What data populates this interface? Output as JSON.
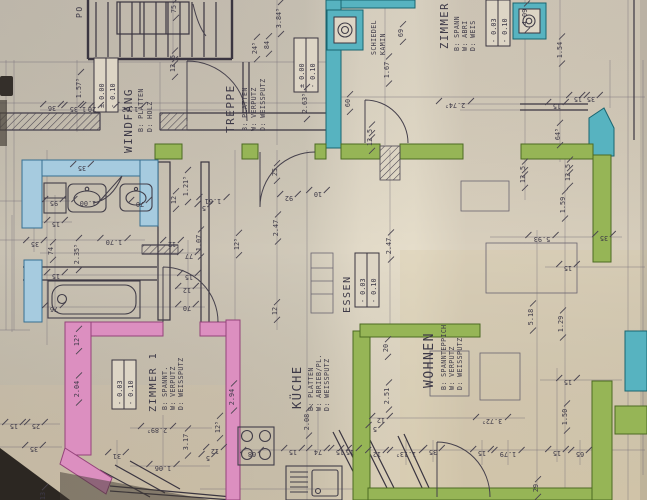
{
  "document": {
    "type": "hand-drawn architectural floor plan (photo, rotated)",
    "language": "German"
  },
  "colors": {
    "paper": "#d5ccba",
    "ink": "#3d3947",
    "wall_blue": "#a6cbdf",
    "wall_teal": "#57b3c0",
    "wall_green": "#96b556",
    "wall_pink": "#dc8fc0"
  },
  "rooms": [
    {
      "id": "windfang",
      "name": "WINDFANG",
      "spec": [
        "B: PLATTEN",
        "D: HOLZ"
      ],
      "level": [
        "± 0.00",
        "- 0.10"
      ]
    },
    {
      "id": "treppe",
      "name": "TREPPE",
      "spec": [
        "B: PLATTEN",
        "W: VERPUTZ",
        "D: WEISSPUTZ"
      ],
      "level": [
        "± 0.00",
        "- 0.10"
      ]
    },
    {
      "id": "zimmer",
      "name": "ZIMMER",
      "spec": [
        "B: SPANN",
        "W: ABRI",
        "D: WEIS"
      ],
      "level": [
        "- 0.03",
        "- 0.10"
      ]
    },
    {
      "id": "essen",
      "name": "ESSEN",
      "spec": [],
      "level": [
        "- 0.03",
        "- 0.10"
      ]
    },
    {
      "id": "wohnen",
      "name": "WOHNEN",
      "spec": [
        "B: SPANNTEPPICH",
        "W: VERPUTZ",
        "D: WEISSPUTZ"
      ],
      "level": null
    },
    {
      "id": "zimmer1",
      "name": "ZIMMER 1",
      "spec": [
        "B: SPANNT.",
        "W: VERPUTZ",
        "D: WEISSPUTZ"
      ],
      "level": [
        "- 0.03",
        "- 0.10"
      ]
    },
    {
      "id": "kueche",
      "name": "KÜCHE",
      "spec": [
        "B: PLATTEN",
        "W: ABRIEB/PL.",
        "D: WEISSPUTZ"
      ],
      "level": null
    },
    {
      "id": "kamin",
      "name": "SCHIEDEL",
      "name2": "KAMIN"
    },
    {
      "id": "stair",
      "name": "PO"
    }
  ],
  "fixtures": [
    "chimney",
    "second-flue",
    "washbasin-large",
    "washbasin-small",
    "cabinet",
    "bathtub",
    "stove-4-burner",
    "kitchen-sink-with-drainboard",
    "dining-table",
    "stair-treads"
  ],
  "dimensions": [
    {
      "t": "75",
      "x": 176,
      "y": 9,
      "r": -90
    },
    {
      "t": "3.84⁵",
      "x": 281,
      "y": 18,
      "r": -90
    },
    {
      "t": "84",
      "x": 269,
      "y": 45,
      "r": -90
    },
    {
      "t": "24⁵",
      "x": 257,
      "y": 48,
      "r": -90
    },
    {
      "t": "1.57⁵",
      "x": 81,
      "y": 88,
      "r": -90
    },
    {
      "t": "69",
      "x": 403,
      "y": 33,
      "r": -90
    },
    {
      "t": "4.09",
      "x": 527,
      "y": 17,
      "r": -90
    },
    {
      "t": "1.54",
      "x": 562,
      "y": 50,
      "r": -90
    },
    {
      "t": "1.67",
      "x": 389,
      "y": 70,
      "r": -90
    },
    {
      "t": "2.63⁵",
      "x": 307,
      "y": 103,
      "r": -90
    },
    {
      "t": "60",
      "x": 350,
      "y": 103,
      "r": -90
    },
    {
      "t": "64⁵",
      "x": 560,
      "y": 134,
      "r": -90
    },
    {
      "t": "5",
      "x": 175,
      "y": 57,
      "r": -90
    },
    {
      "t": "12",
      "x": 175,
      "y": 68,
      "r": -90
    },
    {
      "t": "5",
      "x": 372,
      "y": 131,
      "r": -90
    },
    {
      "t": "12",
      "x": 372,
      "y": 142,
      "r": -90
    },
    {
      "t": "5",
      "x": 525,
      "y": 168,
      "r": -90
    },
    {
      "t": "12",
      "x": 525,
      "y": 179,
      "r": -90
    },
    {
      "t": "5",
      "x": 570,
      "y": 166,
      "r": -90
    },
    {
      "t": "12",
      "x": 570,
      "y": 177,
      "r": -90
    },
    {
      "t": "1.59",
      "x": 565,
      "y": 205,
      "r": -90
    },
    {
      "t": "1.21⁵",
      "x": 188,
      "y": 186,
      "r": -90
    },
    {
      "t": "12",
      "x": 176,
      "y": 200,
      "r": -90
    },
    {
      "t": "2.35⁵",
      "x": 79,
      "y": 254,
      "r": -90
    },
    {
      "t": "74",
      "x": 53,
      "y": 251,
      "r": -90
    },
    {
      "t": "2.47",
      "x": 278,
      "y": 228,
      "r": -90
    },
    {
      "t": "2.47",
      "x": 391,
      "y": 246,
      "r": -90
    },
    {
      "t": "1.07",
      "x": 201,
      "y": 243,
      "r": -90
    },
    {
      "t": "12⁵",
      "x": 239,
      "y": 244,
      "r": -90
    },
    {
      "t": "25",
      "x": 277,
      "y": 172,
      "r": -90
    },
    {
      "t": "12",
      "x": 277,
      "y": 311,
      "r": -90
    },
    {
      "t": "5.18",
      "x": 533,
      "y": 317,
      "r": -90
    },
    {
      "t": "1.29",
      "x": 563,
      "y": 324,
      "r": -90
    },
    {
      "t": "12⁵",
      "x": 79,
      "y": 340,
      "r": -90
    },
    {
      "t": "2.04",
      "x": 79,
      "y": 389,
      "r": -90
    },
    {
      "t": "3.17",
      "x": 188,
      "y": 442,
      "r": -90
    },
    {
      "t": "2.94",
      "x": 234,
      "y": 397,
      "r": -90
    },
    {
      "t": "2.08",
      "x": 309,
      "y": 422,
      "r": -90
    },
    {
      "t": "20",
      "x": 388,
      "y": 348,
      "r": -90
    },
    {
      "t": "2.51",
      "x": 389,
      "y": 396,
      "r": -90
    },
    {
      "t": "12⁵",
      "x": 220,
      "y": 427,
      "r": -90
    },
    {
      "t": "1.50",
      "x": 567,
      "y": 417,
      "r": -90
    },
    {
      "t": "29",
      "x": 538,
      "y": 488,
      "r": -90
    },
    {
      "t": "13",
      "x": 45,
      "y": 496,
      "r": -90
    },
    {
      "t": "1.35",
      "x": 78,
      "y": 107,
      "r": 180
    },
    {
      "t": "20",
      "x": 92,
      "y": 107,
      "r": 180
    },
    {
      "t": "36",
      "x": 52,
      "y": 106,
      "r": 180
    },
    {
      "t": "1.62",
      "x": 130,
      "y": 107,
      "r": 180
    },
    {
      "t": "35",
      "x": 82,
      "y": 166,
      "r": 180
    },
    {
      "t": "95",
      "x": 54,
      "y": 201,
      "r": 180
    },
    {
      "t": "1.00",
      "x": 88,
      "y": 201,
      "r": 180
    },
    {
      "t": "70",
      "x": 140,
      "y": 202,
      "r": 180
    },
    {
      "t": "15",
      "x": 56,
      "y": 222,
      "r": 180
    },
    {
      "t": "35",
      "x": 35,
      "y": 242,
      "r": 180
    },
    {
      "t": "15",
      "x": 56,
      "y": 274,
      "r": 180
    },
    {
      "t": "76",
      "x": 54,
      "y": 307,
      "r": 180
    },
    {
      "t": "1.70",
      "x": 114,
      "y": 240,
      "r": 180
    },
    {
      "t": "12",
      "x": 172,
      "y": 242,
      "r": 180
    },
    {
      "t": "77",
      "x": 189,
      "y": 254,
      "r": 180
    },
    {
      "t": "15",
      "x": 189,
      "y": 275,
      "r": 180
    },
    {
      "t": "12",
      "x": 187,
      "y": 288,
      "r": 180
    },
    {
      "t": "70",
      "x": 187,
      "y": 306,
      "r": 180
    },
    {
      "t": "1.61",
      "x": 213,
      "y": 199,
      "r": 180
    },
    {
      "t": "5",
      "x": 204,
      "y": 206,
      "r": 180
    },
    {
      "t": "92",
      "x": 289,
      "y": 196,
      "r": 180
    },
    {
      "t": "10",
      "x": 318,
      "y": 192,
      "r": 180
    },
    {
      "t": "2.74⁵",
      "x": 455,
      "y": 103,
      "r": 180
    },
    {
      "t": "35",
      "x": 591,
      "y": 97,
      "r": 180
    },
    {
      "t": "15",
      "x": 578,
      "y": 97,
      "r": 180
    },
    {
      "t": "15",
      "x": 557,
      "y": 104,
      "r": 180
    },
    {
      "t": "5.93",
      "x": 542,
      "y": 237,
      "r": 180
    },
    {
      "t": "35",
      "x": 604,
      "y": 236,
      "r": 180
    },
    {
      "t": "15",
      "x": 568,
      "y": 266,
      "r": 180
    },
    {
      "t": "15",
      "x": 14,
      "y": 424,
      "r": 180
    },
    {
      "t": "25",
      "x": 36,
      "y": 424,
      "r": 180
    },
    {
      "t": "35",
      "x": 34,
      "y": 447,
      "r": 180
    },
    {
      "t": "2.89⁵",
      "x": 157,
      "y": 428,
      "r": 180
    },
    {
      "t": "31",
      "x": 117,
      "y": 454,
      "r": 180
    },
    {
      "t": "1.06",
      "x": 163,
      "y": 466,
      "r": 180
    },
    {
      "t": "12",
      "x": 215,
      "y": 449,
      "r": 180
    },
    {
      "t": "5",
      "x": 208,
      "y": 456,
      "r": 180
    },
    {
      "t": "68",
      "x": 252,
      "y": 452,
      "r": 180
    },
    {
      "t": "15",
      "x": 293,
      "y": 450,
      "r": 180
    },
    {
      "t": "74",
      "x": 318,
      "y": 450,
      "r": 180
    },
    {
      "t": "15",
      "x": 340,
      "y": 450,
      "r": 180
    },
    {
      "t": "15",
      "x": 350,
      "y": 450,
      "r": 180
    },
    {
      "t": "12",
      "x": 381,
      "y": 418,
      "r": 180
    },
    {
      "t": "5",
      "x": 375,
      "y": 427,
      "r": 180
    },
    {
      "t": "1.13⁵",
      "x": 406,
      "y": 452,
      "r": 180
    },
    {
      "t": "12",
      "x": 377,
      "y": 452,
      "r": 180
    },
    {
      "t": "1.79",
      "x": 508,
      "y": 452,
      "r": 180
    },
    {
      "t": "3.72⁵",
      "x": 492,
      "y": 419,
      "r": 180
    },
    {
      "t": "35",
      "x": 433,
      "y": 450,
      "r": 180
    },
    {
      "t": "15",
      "x": 482,
      "y": 451,
      "r": 180
    },
    {
      "t": "65",
      "x": 580,
      "y": 452,
      "r": 180
    },
    {
      "t": "15",
      "x": 557,
      "y": 451,
      "r": 180
    },
    {
      "t": "15",
      "x": 568,
      "y": 380,
      "r": 180
    }
  ]
}
